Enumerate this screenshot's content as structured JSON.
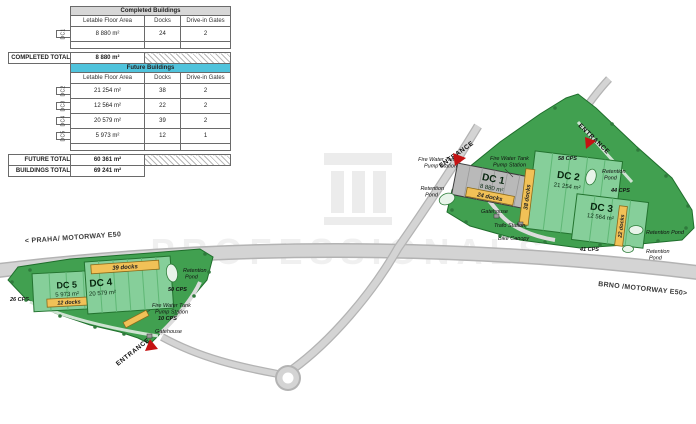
{
  "table": {
    "completed_header": "Completed Buildings",
    "future_header": "Future Buildings",
    "columns": {
      "area": "Letable Floor Area",
      "docks": "Docks",
      "gates": "Drive-in Gates"
    },
    "completed_rows": [
      {
        "name": "DC1",
        "area": "8 880 m²",
        "docks": "24",
        "gates": "2"
      }
    ],
    "completed_total_label": "COMPLETED TOTAL",
    "completed_total_area": "8 880 m²",
    "future_rows": [
      {
        "name": "DC2",
        "area": "21 254 m²",
        "docks": "38",
        "gates": "2"
      },
      {
        "name": "DC3",
        "area": "12 564 m²",
        "docks": "22",
        "gates": "2"
      },
      {
        "name": "DC4",
        "area": "20 579 m²",
        "docks": "39",
        "gates": "2"
      },
      {
        "name": "DC5",
        "area": "5 973 m²",
        "docks": "12",
        "gates": "1"
      }
    ],
    "future_total_label": "FUTURE TOTAL",
    "future_total_area": "60 361 m²",
    "buildings_total_label": "BUILDINGS TOTAL",
    "buildings_total_area": "69 241 m²"
  },
  "map": {
    "motorway_left": "< PRAHA/ MOTORWAY E50",
    "motorway_right": "BRNO /MOTORWAY E50>",
    "watermark": "PROFESSIONALS",
    "buildings": {
      "dc1": {
        "name": "DC 1",
        "area": "8 880 m²",
        "docks_banner": "24 docks"
      },
      "dc2": {
        "name": "DC 2",
        "area": "21 254 m²",
        "docks_banner": "38 docks"
      },
      "dc3": {
        "name": "DC 3",
        "area": "12 564 m²",
        "docks_banner": "22 docks"
      },
      "dc4": {
        "name": "DC 4",
        "area": "20 579 m²",
        "docks_banner": "39 docks"
      },
      "dc5": {
        "name": "DC 5",
        "area": "5 973 m²",
        "docks_banner": "12 docks"
      }
    },
    "labels": {
      "entrance": "ENTRANCE",
      "fire_water_line1": "Fire Water Tank",
      "fire_water_line2": "Pump Station",
      "retention": "Retention",
      "pond": "Pond",
      "retention_pond": "Retention Pond",
      "gatehouse": "Gatehouse",
      "trafo_station": "Trafo Station",
      "bike_canopy": "Bike Canopy",
      "cps_58": "58 CPS",
      "cps_44": "44 CPS",
      "cps_41": "41 CPS",
      "cps_50": "50 CPS",
      "cps_10": "10 CPS",
      "cps_26": "26 CPS"
    },
    "colors": {
      "site_green": "#41a050",
      "building_green": "#86cf9a",
      "building_gray": "#b9b9b9",
      "banner_yellow": "#f1c157",
      "future_header_cyan": "#4fc3dc",
      "entrance_red": "#c41212",
      "road_gray": "#d4d4d4"
    }
  }
}
